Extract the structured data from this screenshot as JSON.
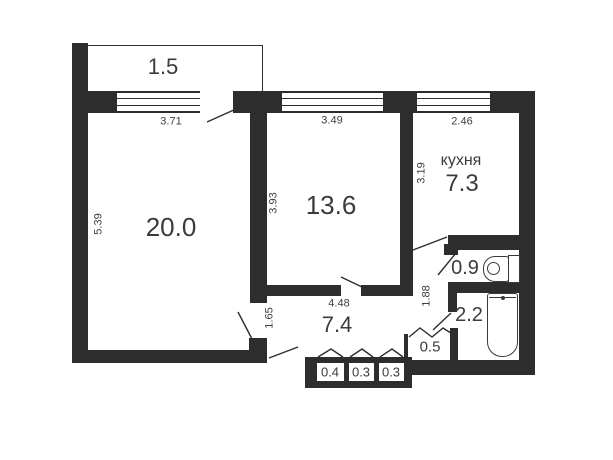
{
  "plan_type": "apartment-floor-plan",
  "rooms": {
    "balcony": {
      "area": "1.5"
    },
    "living_room": {
      "area": "20.0",
      "dim_top": "3.71",
      "dim_side": "5.39"
    },
    "bedroom": {
      "area": "13.6",
      "dim_top": "3.49",
      "dim_side": "3.93"
    },
    "kitchen": {
      "label": "кухня",
      "area": "7.3",
      "dim_top": "2.46",
      "dim_side": "3.19"
    },
    "hallway": {
      "area": "7.4",
      "dim_top": "4.48",
      "dim_side": "1.65"
    },
    "corridor": {
      "dim_side": "1.88"
    },
    "wc": {
      "area": "0.9"
    },
    "bathroom": {
      "area": "2.2"
    },
    "storage": {
      "area": "0.5"
    },
    "closets": [
      {
        "area": "0.4"
      },
      {
        "area": "0.3"
      },
      {
        "area": "0.3"
      }
    ]
  },
  "colors": {
    "wall": "#2d2d2d",
    "text": "#3b3b3b",
    "background": "#ffffff"
  }
}
